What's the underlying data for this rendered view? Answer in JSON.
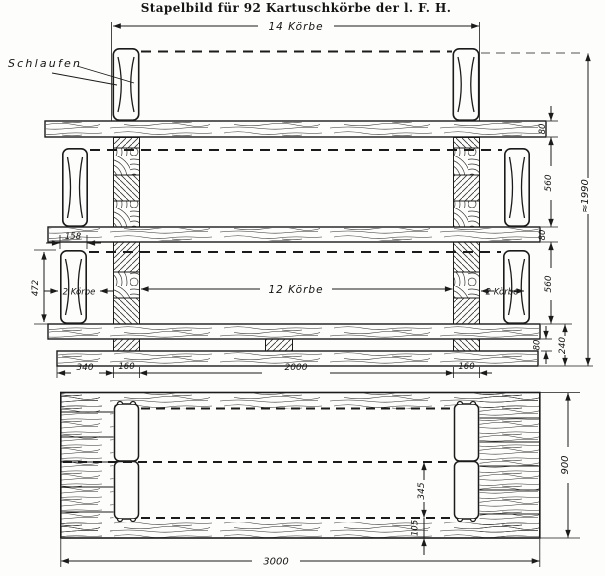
{
  "title": "Stapelbild für 92 Kartuschkörbe der l. F. H.",
  "labels": {
    "schlaufen": "Schlaufen",
    "row_top": "14 Körbe",
    "two_baskets": "2 Körbe",
    "twelve_baskets": "12 Körbe"
  },
  "dimensions": {
    "plank_thickness": "80",
    "row_clear_height": "560",
    "base_height": "240",
    "overall_height": "≈1990",
    "basket_width": "158",
    "basket_height": "472",
    "side_overhang": "340",
    "post_width": "160",
    "inner_span": "2000",
    "plan_post_length": "345",
    "plan_edge_offset": "105",
    "plan_width": "900",
    "plan_length": "3000"
  },
  "colors": {
    "ink": "#1b1b1b",
    "paper": "#fdfdfb"
  }
}
